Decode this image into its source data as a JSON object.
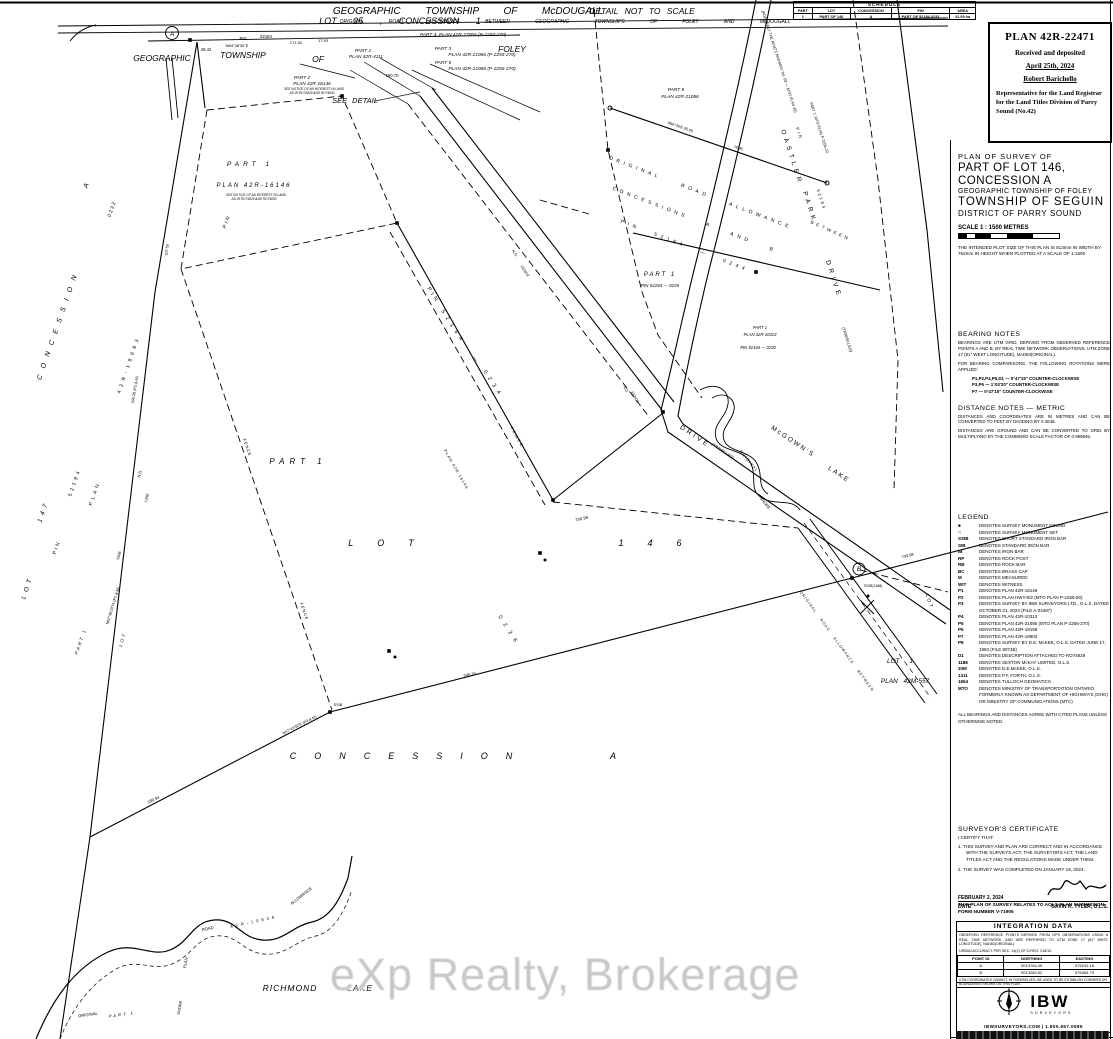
{
  "watermark": "eXp Realty, Brokerage",
  "stamp": {
    "plan_no": "PLAN 42R-22471",
    "line1": "Received and deposited",
    "date": "April 25th, 2024",
    "registrar": "Robert Barichello",
    "role": "Representative for the Land Registrar for the Land Titles Division of Parry Sound (No.42)"
  },
  "title_block": {
    "l1": "PLAN OF SURVEY OF",
    "l2": "PART OF LOT 146,",
    "l3": "CONCESSION A",
    "l4": "GEOGRAPHIC TOWNSHIP OF FOLEY",
    "l5": "TOWNSHIP OF SEGUIN",
    "l6": "DISTRICT OF PARRY SOUND",
    "scale": "SCALE 1 : 1500 METRES",
    "plot_note": "THE INTENDED PLOT SIZE OF THIS PLAN IS 813mm IN WIDTH BY 762mm IN HEIGHT WHEN PLOTTED AT A SCALE OF 1:1500"
  },
  "schedule": {
    "caption": "SCHEDULE",
    "headers": [
      "PART",
      "LOT",
      "CONCESSION",
      "PIN",
      "AREA"
    ],
    "rows": [
      [
        "1",
        "PART OF 146",
        "A",
        "PART OF 52184-0233",
        "22.09 ha"
      ]
    ]
  },
  "bearing_notes": {
    "title": "BEARING NOTES",
    "p1": "BEARINGS ARE UTM GRID, DERIVED FROM OBSERVED REFERENCE POINTS A AND B, BY REAL TIME NETWORK OBSERVATIONS, UTM ZONE 17 (81° WEST LONGITUDE), NAD83(ORIGINAL).",
    "p2": "FOR BEARING COMPARISONS, THE FOLLOWING ROTATIONS WERE APPLIED:",
    "r1": "P1,P2,P4,P5,D1 — 0°47'15\" COUNTER-CLOCKWISE",
    "r2": "P3,P6 — 1°03'20\" COUNTER-CLOCKWISE",
    "r3": "P7 — 0°47'15\" COUNTER-CLOCKWISE"
  },
  "distance_notes": {
    "title": "DISTANCE NOTES — METRIC",
    "p1": "DISTANCES AND COORDINATES ARE IN METRES AND CAN BE CONVERTED TO FEET BY DIVIDING BY 0.3048.",
    "p2": "DISTANCES ARE GROUND AND CAN BE CONVERTED TO GRID BY MULTIPLYING BY THE COMBINED SCALE FACTOR OF 0.999845."
  },
  "legend": {
    "title": "LEGEND",
    "entries": [
      {
        "sym": "■",
        "text": "DENOTES SURVEY MONUMENT FOUND"
      },
      {
        "sym": "□",
        "text": "DENOTES SURVEY MONUMENT SET"
      },
      {
        "sym": "SSIB",
        "text": "DENOTES SHORT STANDARD IRON BAR"
      },
      {
        "sym": "SIB",
        "text": "DENOTES STANDARD IRON BAR"
      },
      {
        "sym": "IB",
        "text": "DENOTES IRON BAR"
      },
      {
        "sym": "RP",
        "text": "DENOTES ROCK POST"
      },
      {
        "sym": "RB",
        "text": "DENOTES ROCK BAR"
      },
      {
        "sym": "BC",
        "text": "DENOTES BRASS CAP"
      },
      {
        "sym": "M",
        "text": "DENOTES MEASURED"
      },
      {
        "sym": "WIT",
        "text": "DENOTES WITNESS"
      },
      {
        "sym": "P1",
        "text": "DENOTES PLAN 42R-16146"
      },
      {
        "sym": "P2",
        "text": "DENOTES PLAN HWY402 (MTO PLAN P-2255-50)"
      },
      {
        "sym": "P3",
        "text": "DENOTES SURVEY BY IBW SURVEYORS LTD., O.L.S. DATED OCTOBER 31, 2023 (FILE A-04487)"
      },
      {
        "sym": "P4",
        "text": "DENOTES PLAN 42R-10313"
      },
      {
        "sym": "P5",
        "text": "DENOTES PLAN 42R-21086 (MTO PLAN P-2255-270)"
      },
      {
        "sym": "P6",
        "text": "DENOTES PLAN 42R-19198"
      },
      {
        "sym": "P7",
        "text": "DENOTES PLAN 42R-18903"
      },
      {
        "sym": "P8",
        "text": "DENOTES SURVEY BY D.E. McKEE, O.L.S. DATED JUNE 17, 1983 (FILE 8074B)"
      },
      {
        "sym": "D1",
        "text": "DENOTES DESCRIPTION ATTACHED TO RO74829"
      },
      {
        "sym": "1188",
        "text": "DENOTES SEXTON McKAY LIMITED, O.L.S."
      },
      {
        "sym": "20M",
        "text": "DENOTES D.E.McKEE, O.L.S."
      },
      {
        "sym": "1311",
        "text": "DENOTES P.F. FORTH, O.L.S."
      },
      {
        "sym": "1654",
        "text": "DENOTES TULLOCH GEOMATICS"
      },
      {
        "sym": "MTO",
        "text": "DENOTES MINISTRY OF TRANSPORTATION ONTARIO, FORMERLY KNOWN AS DEPARTMENT OF HIGHWAYS (DHO) OR MINISTRY OF COMMUNICATIONS (MTC)"
      }
    ],
    "footer": "ALL BEARINGS AND DISTANCES AGREE WITH CITED PLANS UNLESS OTHERWISE NOTED."
  },
  "certificate": {
    "title": "SURVEYOR'S CERTIFICATE",
    "intro": "I CERTIFY THAT:",
    "item1": "1. THIS SURVEY AND PLAN ARE CORRECT AND IN ACCORDANCE WITH THE SURVEYS ACT, THE SURVEYORS ACT, THE LAND TITLES ACT AND THE REGULATIONS MADE UNDER THEM.",
    "item2": "2. THE SURVEY WAS COMPLETED ON JANUARY 19, 2024.",
    "date": "FEBRUARY 2, 2024",
    "date_label": "DATE",
    "surveyor": "GAVIN K. TYLER, O.L.S."
  },
  "aols_note": "THIS PLAN OF SURVEY RELATES TO AOLS PLAN SUBMISSION FORM NUMBER V-71905",
  "integration": {
    "title": "INTEGRATION DATA",
    "p1": "OBSERVED REFERENCE POINTS DERIVED FROM GPS OBSERVATIONS USING A REAL TIME NETWORK, AND ARE REFERRED TO UTM ZONE 17 (81° WEST LONGITUDE), NAD83(ORIGINAL).",
    "p2": "URBAN ACCURACY PER SEC. 14(2) OF O.REG. 216/10.",
    "headers": [
      "POINT ID",
      "NORTHING",
      "EASTING"
    ],
    "rows": [
      [
        "A",
        "5013764.45",
        "575231.18"
      ],
      [
        "B",
        "5013260.92",
        "576384.79"
      ]
    ],
    "footer": "UTM COORDINATES CANNOT, IN THEMSELVES, BE USED TO RE-ESTABLISH CORNERS OR BOUNDARIES SHOWN ON THIS PLAN."
  },
  "logo": {
    "name": "IBW",
    "sub": "SURVEYORS",
    "contact": "IBWSURVEYORS.COM | 1.800.667.0695"
  },
  "map": {
    "labels": [
      {
        "t": "GEOGRAPHIC  TOWNSHIP  OF  McDOUGALL",
        "x": 468,
        "y": 14,
        "s": 10,
        "ws": 22,
        "i": 1
      },
      {
        "t": "LOT  25  ,  CONCESSION  1",
        "x": 400,
        "y": 24,
        "s": 9,
        "ws": 14,
        "i": 1
      },
      {
        "t": "ORIGINAL ROAD ALLOWANCE BETWEEN GEOGRAPHIC TOWNSHIPS OF FOLEY AND McDOUGALL",
        "x": 565,
        "y": 23,
        "s": 5,
        "ws": 24,
        "i": 1
      },
      {
        "t": "DETAIL NOT TO SCALE",
        "x": 642,
        "y": 14,
        "s": 8.5,
        "ws": 4,
        "i": 1
      },
      {
        "t": "GEOGRAPHIC",
        "x": 162,
        "y": 61,
        "s": 8.5,
        "i": 1
      },
      {
        "t": "TOWNSHIP",
        "x": 243,
        "y": 58,
        "s": 8.5,
        "i": 1
      },
      {
        "t": "OF",
        "x": 318,
        "y": 62,
        "s": 8.5,
        "i": 1
      },
      {
        "t": "FOLEY",
        "x": 512,
        "y": 52,
        "s": 8.5,
        "i": 1
      },
      {
        "t": "A",
        "x": 172,
        "y": 36,
        "s": 6.5,
        "i": 1
      },
      {
        "t": "PIN",
        "x": 243,
        "y": 40,
        "s": 4.2
      },
      {
        "t": "52184",
        "x": 266,
        "y": 38,
        "s": 4.2
      },
      {
        "t": "N84°48'30\"E",
        "x": 237,
        "y": 47,
        "s": 4
      },
      {
        "t": "49.42",
        "x": 206,
        "y": 51,
        "s": 4.2
      },
      {
        "t": "171.52",
        "x": 296,
        "y": 44,
        "s": 4
      },
      {
        "t": "17.93",
        "x": 323,
        "y": 42,
        "s": 4
      },
      {
        "t": "PART 1",
        "x": 363,
        "y": 52,
        "s": 4.8,
        "i": 1
      },
      {
        "t": "PLAN 42R-4111",
        "x": 366,
        "y": 58,
        "s": 4.8,
        "i": 1
      },
      {
        "t": "PART 4, PLAN 42R-27066 (P-2255-270)",
        "x": 420,
        "y": 36,
        "s": 4.8,
        "i": 1,
        "a": "start"
      },
      {
        "t": "PART 3",
        "x": 443,
        "y": 50,
        "s": 4.8,
        "i": 1
      },
      {
        "t": "PLAN 42R-21086  (P-2255-270)",
        "x": 482,
        "y": 56,
        "s": 4.8,
        "i": 1
      },
      {
        "t": "PART 5",
        "x": 443,
        "y": 64,
        "s": 4.8,
        "i": 1
      },
      {
        "t": "PLAN 42R-21086  (P-2255-270)",
        "x": 482,
        "y": 70,
        "s": 4.8,
        "i": 1
      },
      {
        "t": "PART 2",
        "x": 302,
        "y": 79,
        "s": 4.8,
        "i": 1
      },
      {
        "t": "PLAN 42R-16146",
        "x": 312,
        "y": 85,
        "s": 4.8,
        "i": 1
      },
      {
        "t": "SEE NOTICE OF AN INTEREST IN LAND",
        "x": 314,
        "y": 90,
        "s": 3.2,
        "i": 1
      },
      {
        "t": "AS IN RO74829 AND RO74830",
        "x": 312,
        "y": 94,
        "s": 3.2,
        "i": 1
      },
      {
        "t": "SEE DETAIL",
        "x": 355,
        "y": 103,
        "s": 7.5,
        "ws": 3,
        "i": 1
      },
      {
        "t": "190.70",
        "x": 392,
        "y": 77,
        "s": 4.2
      },
      {
        "t": "PART  1",
        "x": 250,
        "y": 166,
        "s": 6.5,
        "ls": 4,
        "i": 1
      },
      {
        "t": "PLAN  42R-16146",
        "x": 254,
        "y": 187,
        "s": 6,
        "ls": 2,
        "i": 1
      },
      {
        "t": "SEE NOTICE OF AN INTEREST IN LAND",
        "x": 256,
        "y": 196,
        "s": 3.2,
        "i": 1
      },
      {
        "t": "AS IN RO74829 AND RO74830",
        "x": 254,
        "y": 200,
        "s": 3.2,
        "i": 1
      },
      {
        "t": "PIN",
        "x": 228,
        "y": 222,
        "s": 5,
        "r": -70,
        "ls": 2,
        "i": 1
      },
      {
        "t": "A",
        "x": 88,
        "y": 186,
        "s": 7,
        "r": -71,
        "i": 1
      },
      {
        "t": "0 2 3 2",
        "x": 113,
        "y": 210,
        "s": 5,
        "r": -71
      },
      {
        "t": "CONCESSION",
        "x": 60,
        "y": 325,
        "s": 7,
        "r": -71,
        "ls": 7,
        "i": 1
      },
      {
        "t": "42R-18983",
        "x": 130,
        "y": 365,
        "s": 5,
        "r": -71,
        "ls": 4
      },
      {
        "t": "52184",
        "x": 76,
        "y": 483,
        "s": 5,
        "r": -71,
        "ls": 3
      },
      {
        "t": "PLAN",
        "x": 96,
        "y": 494,
        "s": 5,
        "r": -71,
        "ls": 3
      },
      {
        "t": "147",
        "x": 45,
        "y": 512,
        "s": 6.5,
        "r": -71,
        "ls": 4,
        "i": 1
      },
      {
        "t": "LOT",
        "x": 29,
        "y": 588,
        "s": 6.5,
        "r": -71,
        "ls": 4,
        "i": 1
      },
      {
        "t": "PIN",
        "x": 58,
        "y": 548,
        "s": 5,
        "r": -71,
        "ls": 2
      },
      {
        "t": "N.D.",
        "x": 141,
        "y": 474,
        "s": 4,
        "r": -73
      },
      {
        "t": "LINE",
        "x": 148,
        "y": 498,
        "s": 4,
        "r": -73
      },
      {
        "t": "SSIB",
        "x": 120,
        "y": 556,
        "s": 3.8,
        "r": -73
      },
      {
        "t": "N62°38'10\"W (P2 & M)",
        "x": 114,
        "y": 606,
        "s": 3.8,
        "r": -73
      },
      {
        "t": "345.28 (P3 & M)",
        "x": 136,
        "y": 390,
        "s": 3.8,
        "r": -80
      },
      {
        "t": "107.50",
        "x": 168,
        "y": 250,
        "s": 3.8,
        "r": -82
      },
      {
        "t": "PART 1",
        "x": 82,
        "y": 642,
        "s": 4.5,
        "r": -71,
        "ls": 2,
        "i": 1
      },
      {
        "t": "LOT",
        "x": 124,
        "y": 640,
        "s": 4.5,
        "r": -71,
        "ls": 2,
        "i": 1
      },
      {
        "t": "PART 1",
        "x": 298,
        "y": 464,
        "s": 8,
        "ls": 5,
        "i": 1
      },
      {
        "t": "LOT",
        "x": 393,
        "y": 546,
        "s": 9,
        "ls": 24,
        "i": 1
      },
      {
        "t": "146",
        "x": 662,
        "y": 546,
        "s": 9,
        "ls": 24,
        "i": 1
      },
      {
        "t": "CONCESSION",
        "x": 410,
        "y": 759,
        "s": 9,
        "ls": 18,
        "i": 1
      },
      {
        "t": "A",
        "x": 613,
        "y": 759,
        "s": 9,
        "i": 1
      },
      {
        "t": "PIN",
        "x": 432,
        "y": 296,
        "s": 5.5,
        "r": 57,
        "ls": 3
      },
      {
        "t": "52184",
        "x": 452,
        "y": 328,
        "s": 5.5,
        "r": 57,
        "ls": 5
      },
      {
        "t": "—",
        "x": 474,
        "y": 360,
        "s": 5.5,
        "r": 57
      },
      {
        "t": "0234",
        "x": 492,
        "y": 385,
        "s": 5.5,
        "r": 57,
        "ls": 5
      },
      {
        "t": "0236",
        "x": 508,
        "y": 632,
        "s": 5.5,
        "r": 57,
        "ls": 6
      },
      {
        "t": "FENCE",
        "x": 516,
        "y": 438,
        "s": 4,
        "r": 60,
        "ls": 2
      },
      {
        "t": "FENCE",
        "x": 246,
        "y": 448,
        "s": 4,
        "r": 71,
        "ls": 1
      },
      {
        "t": "FENCE",
        "x": 303,
        "y": 612,
        "s": 4,
        "r": 71,
        "ls": 1
      },
      {
        "t": "PLAN 42R-16146",
        "x": 455,
        "y": 470,
        "s": 4,
        "r": 60,
        "ls": 1
      },
      {
        "t": "N.D.",
        "x": 514,
        "y": 254,
        "s": 3.8,
        "r": 54
      },
      {
        "t": "FENCE",
        "x": 524,
        "y": 272,
        "s": 3.8,
        "r": 54
      },
      {
        "t": "N.D.",
        "x": 625,
        "y": 390,
        "s": 3.8,
        "r": 60
      },
      {
        "t": "FENCE",
        "x": 634,
        "y": 398,
        "s": 3.8,
        "r": 60
      },
      {
        "t": "SSIB",
        "x": 338,
        "y": 706,
        "s": 3.8
      },
      {
        "t": "295.15",
        "x": 470,
        "y": 676,
        "s": 4.2,
        "r": -14
      },
      {
        "t": "700.98",
        "x": 582,
        "y": 520,
        "s": 4.2,
        "r": -14
      },
      {
        "t": "186.94",
        "x": 154,
        "y": 801,
        "s": 4.2,
        "r": -26
      },
      {
        "t": "N47°42'30\"E (P3 & M)",
        "x": 300,
        "y": 726,
        "s": 3.8,
        "r": -27
      },
      {
        "t": "OASTLER",
        "x": 790,
        "y": 158,
        "s": 6.5,
        "r": 72,
        "ls": 4
      },
      {
        "t": "PARK",
        "x": 808,
        "y": 208,
        "s": 6.5,
        "r": 72,
        "ls": 4
      },
      {
        "t": "DRIVE",
        "x": 832,
        "y": 280,
        "s": 6.5,
        "r": 72,
        "ls": 4
      },
      {
        "t": "PIN",
        "x": 798,
        "y": 134,
        "s": 4.2,
        "r": 72,
        "ls": 2
      },
      {
        "t": "52184",
        "x": 820,
        "y": 200,
        "s": 4.2,
        "r": 72,
        "ls": 2
      },
      {
        "t": "BETWEEN",
        "x": 830,
        "y": 232,
        "s": 4.5,
        "r": 24,
        "ls": 3
      },
      {
        "t": "(TRAVELLED)",
        "x": 722,
        "y": 452,
        "s": 4,
        "r": 34,
        "i": 1
      },
      {
        "t": "(TRAVELLED)",
        "x": 846,
        "y": 340,
        "s": 4,
        "r": 72,
        "i": 1
      },
      {
        "t": "DRIVE",
        "x": 694,
        "y": 438,
        "s": 6.5,
        "r": 34,
        "ls": 3
      },
      {
        "t": "McGOWN'S",
        "x": 792,
        "y": 443,
        "s": 6.5,
        "r": 34,
        "ls": 2
      },
      {
        "t": "LAKE",
        "x": 838,
        "y": 476,
        "s": 6.5,
        "r": 34,
        "ls": 2
      },
      {
        "t": "PART 8",
        "x": 676,
        "y": 91,
        "s": 4.8,
        "i": 1
      },
      {
        "t": "PLAN 42R-21086",
        "x": 680,
        "y": 98,
        "s": 4.8,
        "i": 1
      },
      {
        "t": "ORIGINAL   ROAD   ALLOWANCE",
        "x": 700,
        "y": 194,
        "s": 5,
        "r": 21,
        "ls": 4,
        "ws": 16
      },
      {
        "t": "CONCESSIONS   A   AND   B",
        "x": 694,
        "y": 221,
        "s": 5,
        "r": 21,
        "ls": 4,
        "ws": 14
      },
      {
        "t": "PIN   52184  —  0244",
        "x": 684,
        "y": 247,
        "s": 5,
        "r": 21,
        "ls": 4,
        "ws": 10
      },
      {
        "t": "PART 1",
        "x": 660,
        "y": 276,
        "s": 6,
        "ls": 2,
        "i": 1
      },
      {
        "t": "PIN 52184 — 0235",
        "x": 660,
        "y": 287,
        "s": 4.5,
        "i": 1
      },
      {
        "t": "PART 1",
        "x": 760,
        "y": 329,
        "s": 4.2,
        "i": 1
      },
      {
        "t": "PLAN 42R-10313",
        "x": 760,
        "y": 336,
        "s": 4.2,
        "i": 1
      },
      {
        "t": "PIN 52184 — 0230",
        "x": 758,
        "y": 349,
        "s": 4.2,
        "i": 1
      },
      {
        "t": "N84°45'E  35.05",
        "x": 680,
        "y": 128,
        "s": 3.8,
        "r": 19
      },
      {
        "t": "19.35",
        "x": 738,
        "y": 149,
        "s": 3.8,
        "r": 19
      },
      {
        "t": "(FORMERLY THE KING'S HIGHWAY No. 69 — MTO PLAN 40)",
        "x": 778,
        "y": 62,
        "s": 3.8,
        "r": 72,
        "i": 1
      },
      {
        "t": "PART 1, MTO PLAN P-2255-22",
        "x": 818,
        "y": 128,
        "s": 3.8,
        "r": 72
      },
      {
        "t": "ORIGINAL",
        "x": 748,
        "y": 462,
        "s": 4,
        "r": 50,
        "ls": 1
      },
      {
        "t": "SHORE",
        "x": 764,
        "y": 504,
        "s": 4,
        "r": 50
      },
      {
        "t": "B",
        "x": 859,
        "y": 571,
        "s": 6.5,
        "i": 1
      },
      {
        "t": "SSIB(1188)",
        "x": 864,
        "y": 587,
        "s": 3.6,
        "a": "start"
      },
      {
        "t": "LOT  1",
        "x": 900,
        "y": 663,
        "s": 6.5,
        "ws": 8,
        "i": 1
      },
      {
        "t": "PLAN  42M-557",
        "x": 905,
        "y": 683,
        "s": 6.5,
        "ws": 4,
        "i": 1
      },
      {
        "t": "ORIGINAL  ROAD  ALLOWANCE  BETWEEN",
        "x": 836,
        "y": 642,
        "s": 3.8,
        "r": 54,
        "ls": 1,
        "ws": 6
      },
      {
        "t": "LOT",
        "x": 928,
        "y": 602,
        "s": 5,
        "r": 72,
        "ls": 2
      },
      {
        "t": "733.98",
        "x": 908,
        "y": 557,
        "s": 4,
        "r": -15
      },
      {
        "t": "RICHMOND",
        "x": 290,
        "y": 991,
        "s": 8.5,
        "ls": 1,
        "i": 1
      },
      {
        "t": "LAKE",
        "x": 360,
        "y": 991,
        "s": 8.5,
        "ls": 1,
        "i": 1
      },
      {
        "t": "ORIGINAL",
        "x": 88,
        "y": 1016,
        "s": 4.2,
        "r": -8,
        "i": 1
      },
      {
        "t": "PART 1",
        "x": 122,
        "y": 1016,
        "s": 4.2,
        "r": -8,
        "ls": 2,
        "i": 1
      },
      {
        "t": "PLAN",
        "x": 187,
        "y": 963,
        "s": 4.2,
        "r": -80
      },
      {
        "t": "ROAD",
        "x": 208,
        "y": 930,
        "s": 4.2,
        "r": -12
      },
      {
        "t": "42R-10939",
        "x": 254,
        "y": 923,
        "s": 4.2,
        "r": -12,
        "ls": 3
      },
      {
        "t": "SHORE",
        "x": 181,
        "y": 1008,
        "s": 4,
        "r": -80
      },
      {
        "t": "ALLOWANCE",
        "x": 302,
        "y": 897,
        "s": 4.2,
        "r": -38
      }
    ]
  }
}
